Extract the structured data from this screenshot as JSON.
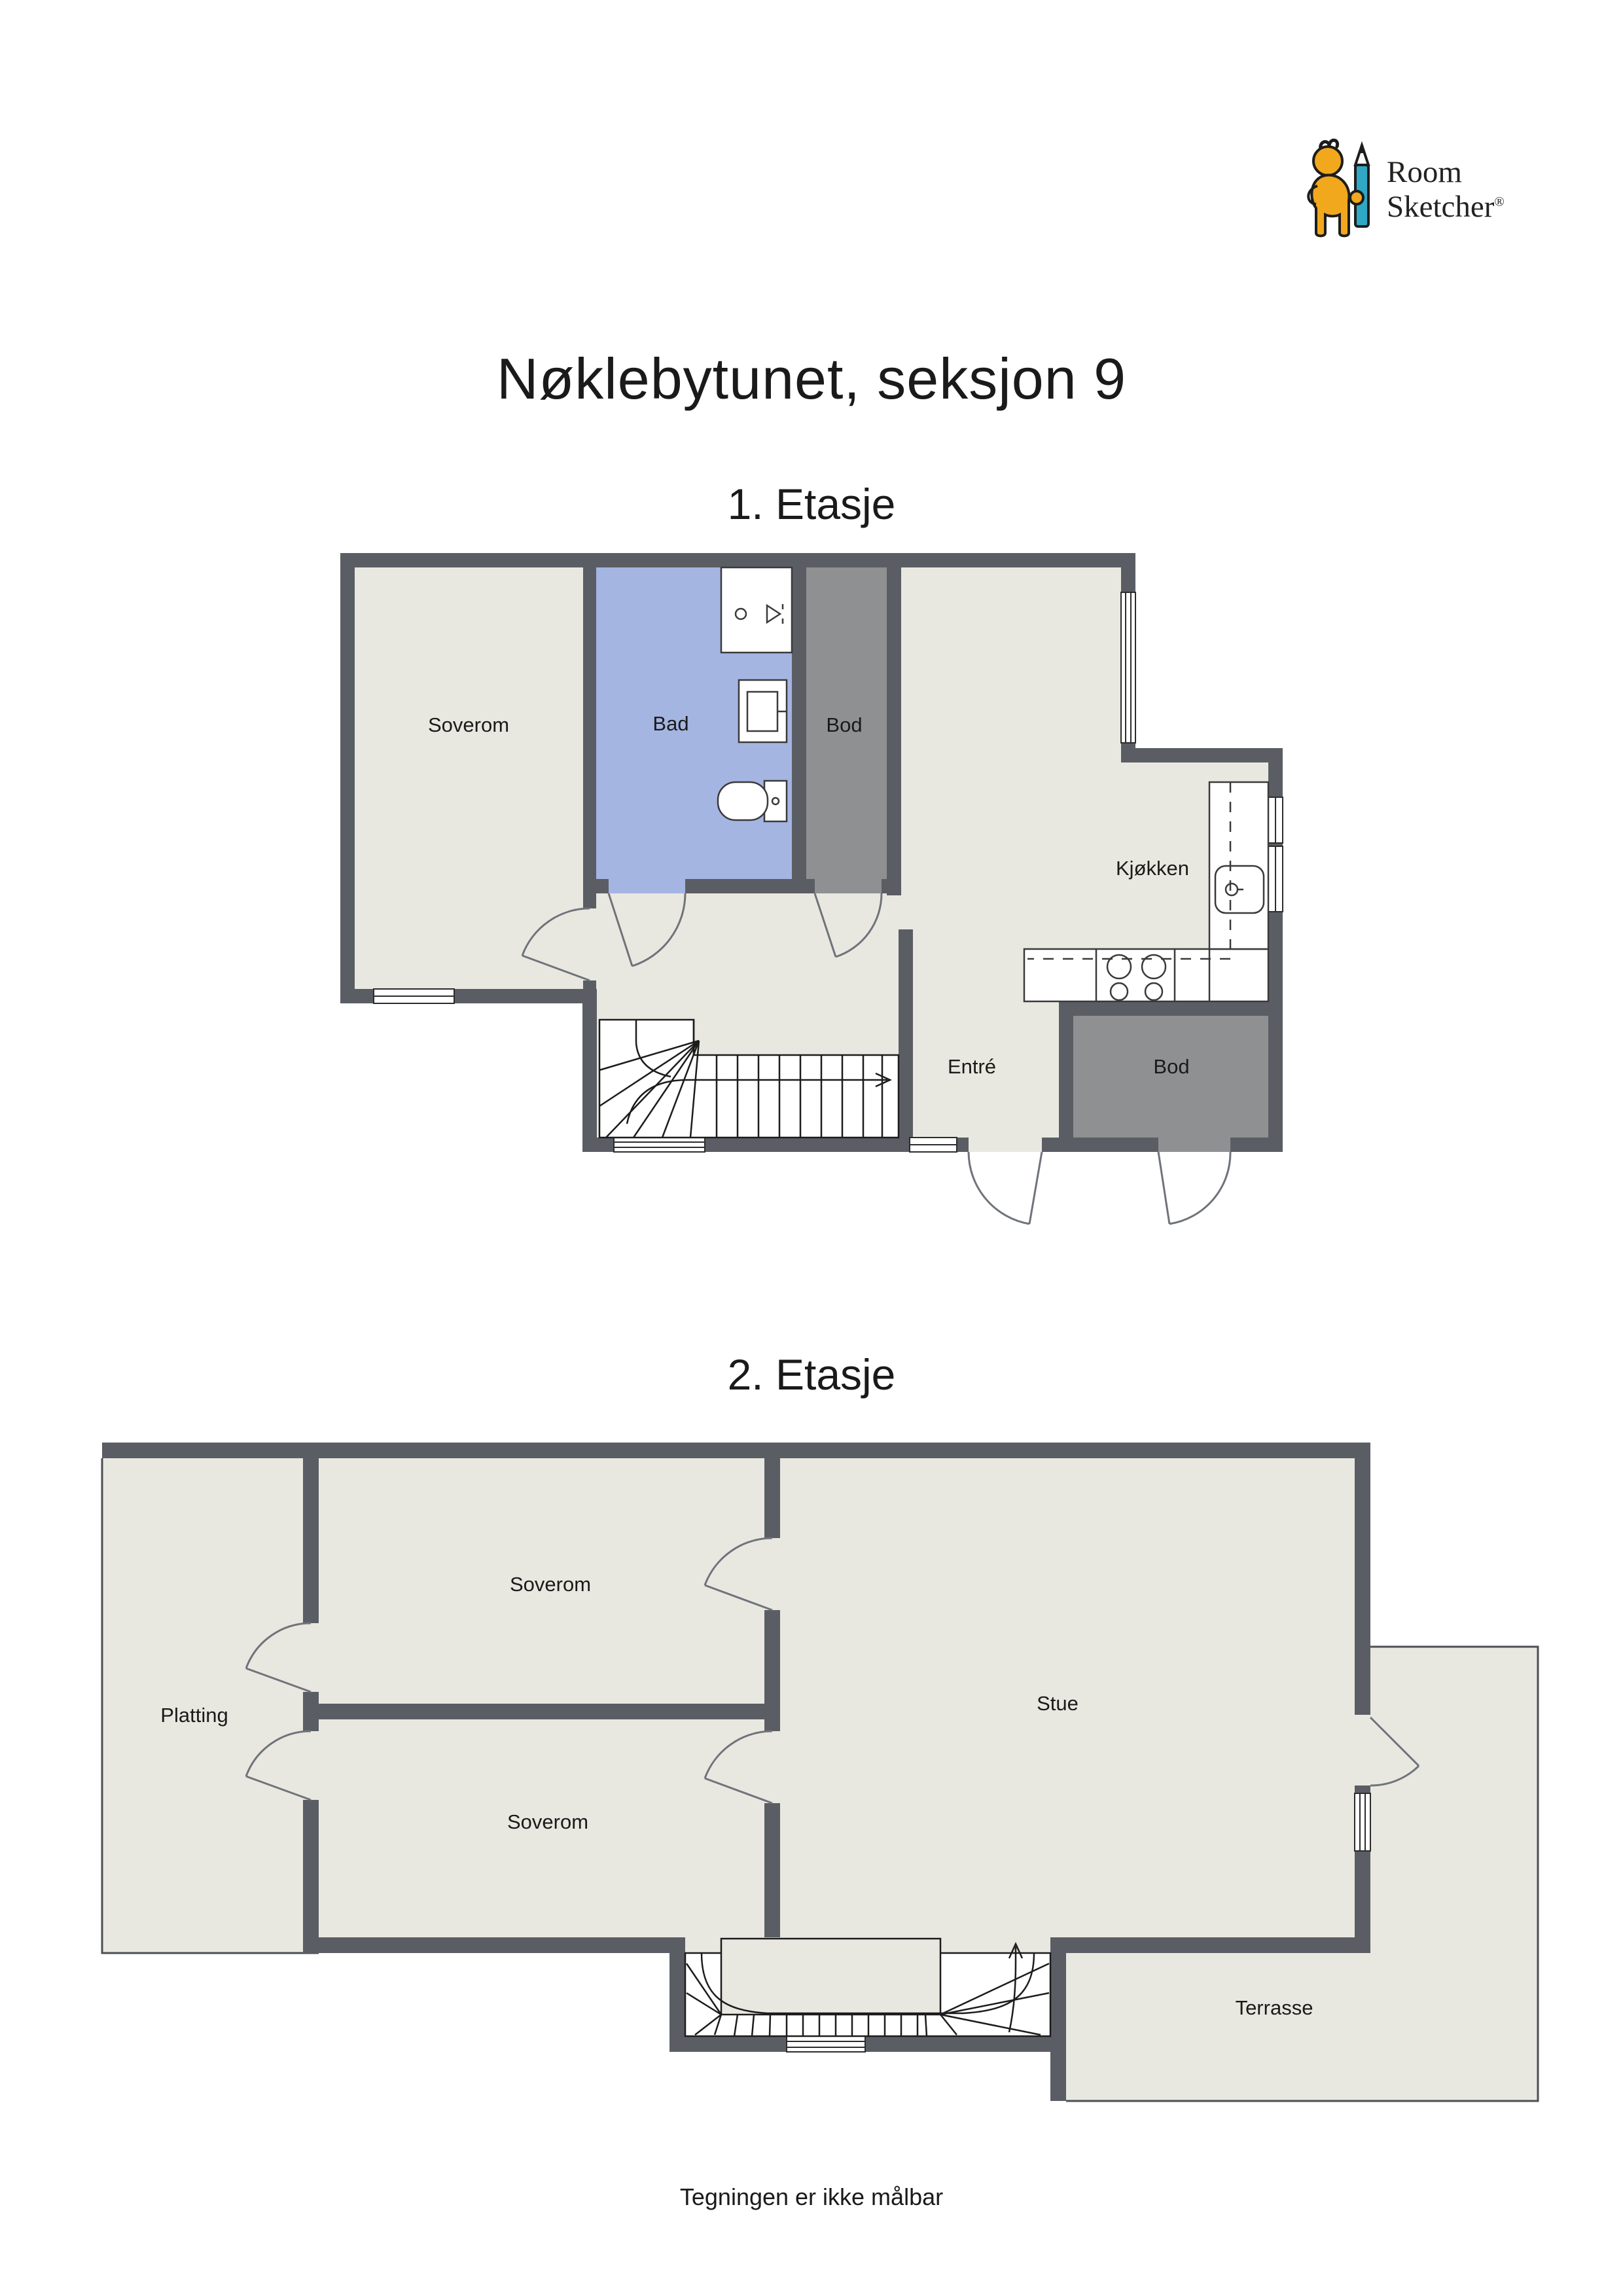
{
  "page": {
    "title": "Nøklebytunet, seksjon 9",
    "footer": "Tegningen er ikke målbar"
  },
  "logo": {
    "line1": "Room",
    "line2": "Sketcher",
    "registered": "®"
  },
  "colors": {
    "wall": "#5a5e64",
    "floor": "#e9e8e0",
    "bath": "#a5b5e2",
    "storage": "#8f9091",
    "accent-yellow": "#f2a81d",
    "accent-teal": "#2fa8c5"
  },
  "floors": [
    {
      "heading": "1. Etasje",
      "rooms": [
        {
          "id": "soverom",
          "label": "Soverom"
        },
        {
          "id": "bad",
          "label": "Bad"
        },
        {
          "id": "bod-top",
          "label": "Bod"
        },
        {
          "id": "kjokken",
          "label": "Kjøkken"
        },
        {
          "id": "entre",
          "label": "Entré"
        },
        {
          "id": "bod-bottom",
          "label": "Bod"
        }
      ]
    },
    {
      "heading": "2. Etasje",
      "rooms": [
        {
          "id": "soverom-top",
          "label": "Soverom"
        },
        {
          "id": "soverom-bottom",
          "label": "Soverom"
        },
        {
          "id": "platting",
          "label": "Platting"
        },
        {
          "id": "stue",
          "label": "Stue"
        },
        {
          "id": "terrasse",
          "label": "Terrasse"
        }
      ]
    }
  ]
}
